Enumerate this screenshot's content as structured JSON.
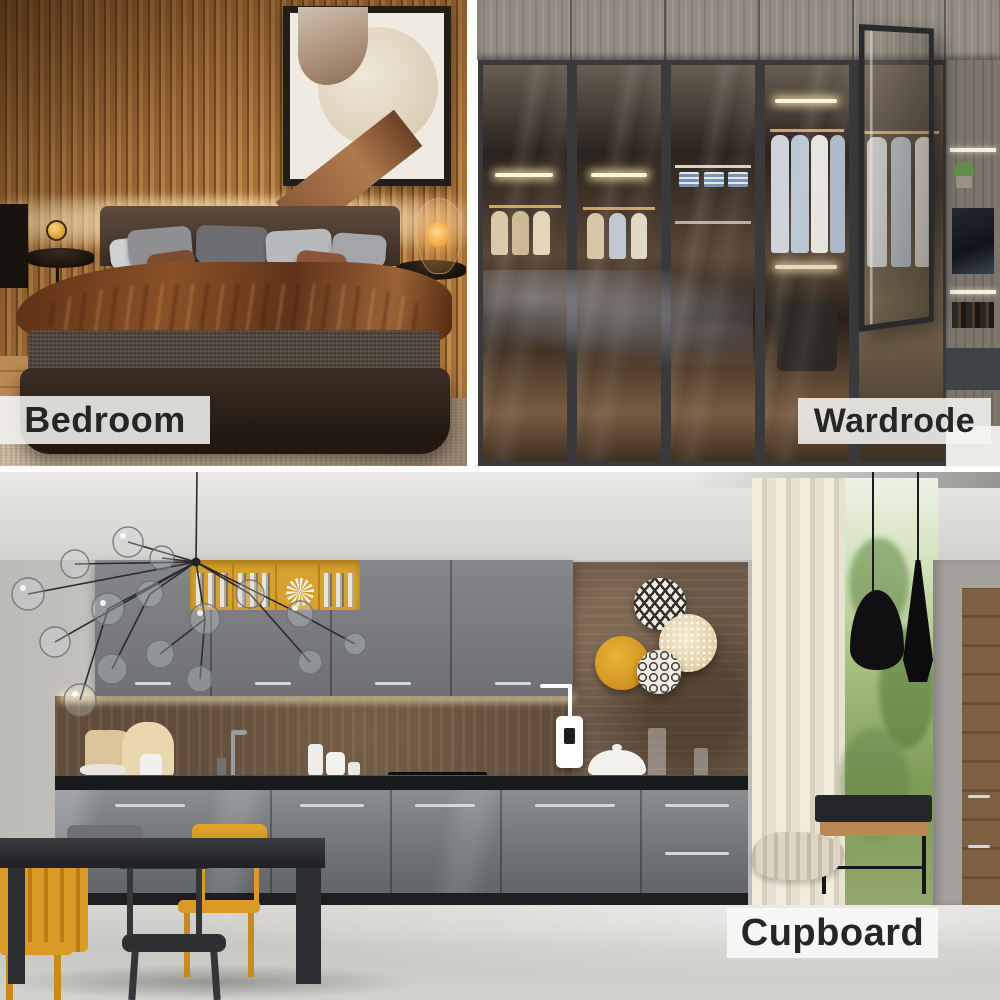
{
  "collage": {
    "type": "interior-product-photo-collage",
    "panels": [
      {
        "id": "bedroom",
        "label": "Bedroom",
        "scene": "bed with brown bedding, wood slat wall, framed art, bedside lamps"
      },
      {
        "id": "wardrobe",
        "label": "Wardrode",
        "scene": "glass-door wardrobe with lit hanging clothes, one door open"
      },
      {
        "id": "cupboard",
        "label": "Cupboard",
        "scene": "gray kitchen cupboards, yellow chairs, wall plates, window with pendant lamps"
      }
    ]
  },
  "labels": {
    "bedroom": "Bedroom",
    "wardrobe": "Wardrode",
    "cupboard": "Cupboard"
  },
  "style": {
    "label_background": "#f4f3f1",
    "label_text_color": "#262626",
    "divider_color": "#ffffff",
    "accent_yellow": "#d7a12f",
    "chair_yellow": "#d99a26",
    "cabinet_gray": "#7b7e81",
    "warm_wood": "#b07a42",
    "led_glow": "#ffe9bd"
  }
}
